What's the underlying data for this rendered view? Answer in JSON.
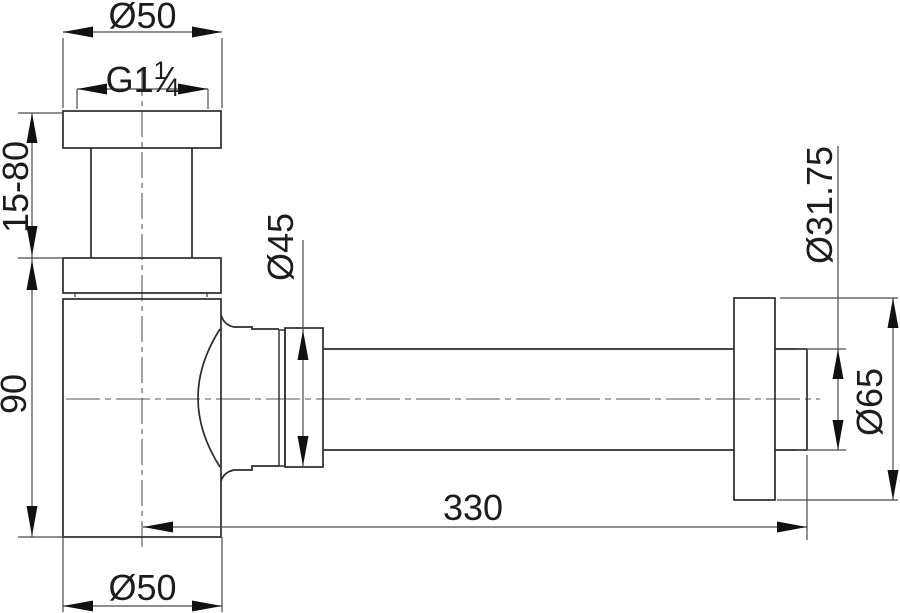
{
  "drawing": {
    "title": "bottle-trap-siphon-technical-drawing",
    "view": "side-elevation",
    "colors": {
      "background": "#ffffff",
      "outline": "#2b2b2b",
      "dim_line": "#4a4a4a",
      "text": "#1c1c1c"
    },
    "dimensions": {
      "inlet_flange_diameter": "Ø50",
      "thread": {
        "prefix": "G1",
        "numerator": "1",
        "slash": "⁄",
        "denominator": "4"
      },
      "adjustable_height": "15-80",
      "body_height": "90",
      "outlet_nut_diameter": "Ø45",
      "body_diameter": "Ø50",
      "horizontal_length": "330",
      "outlet_pipe_diameter": "Ø31.75",
      "wall_flange_diameter": "Ø65"
    }
  }
}
